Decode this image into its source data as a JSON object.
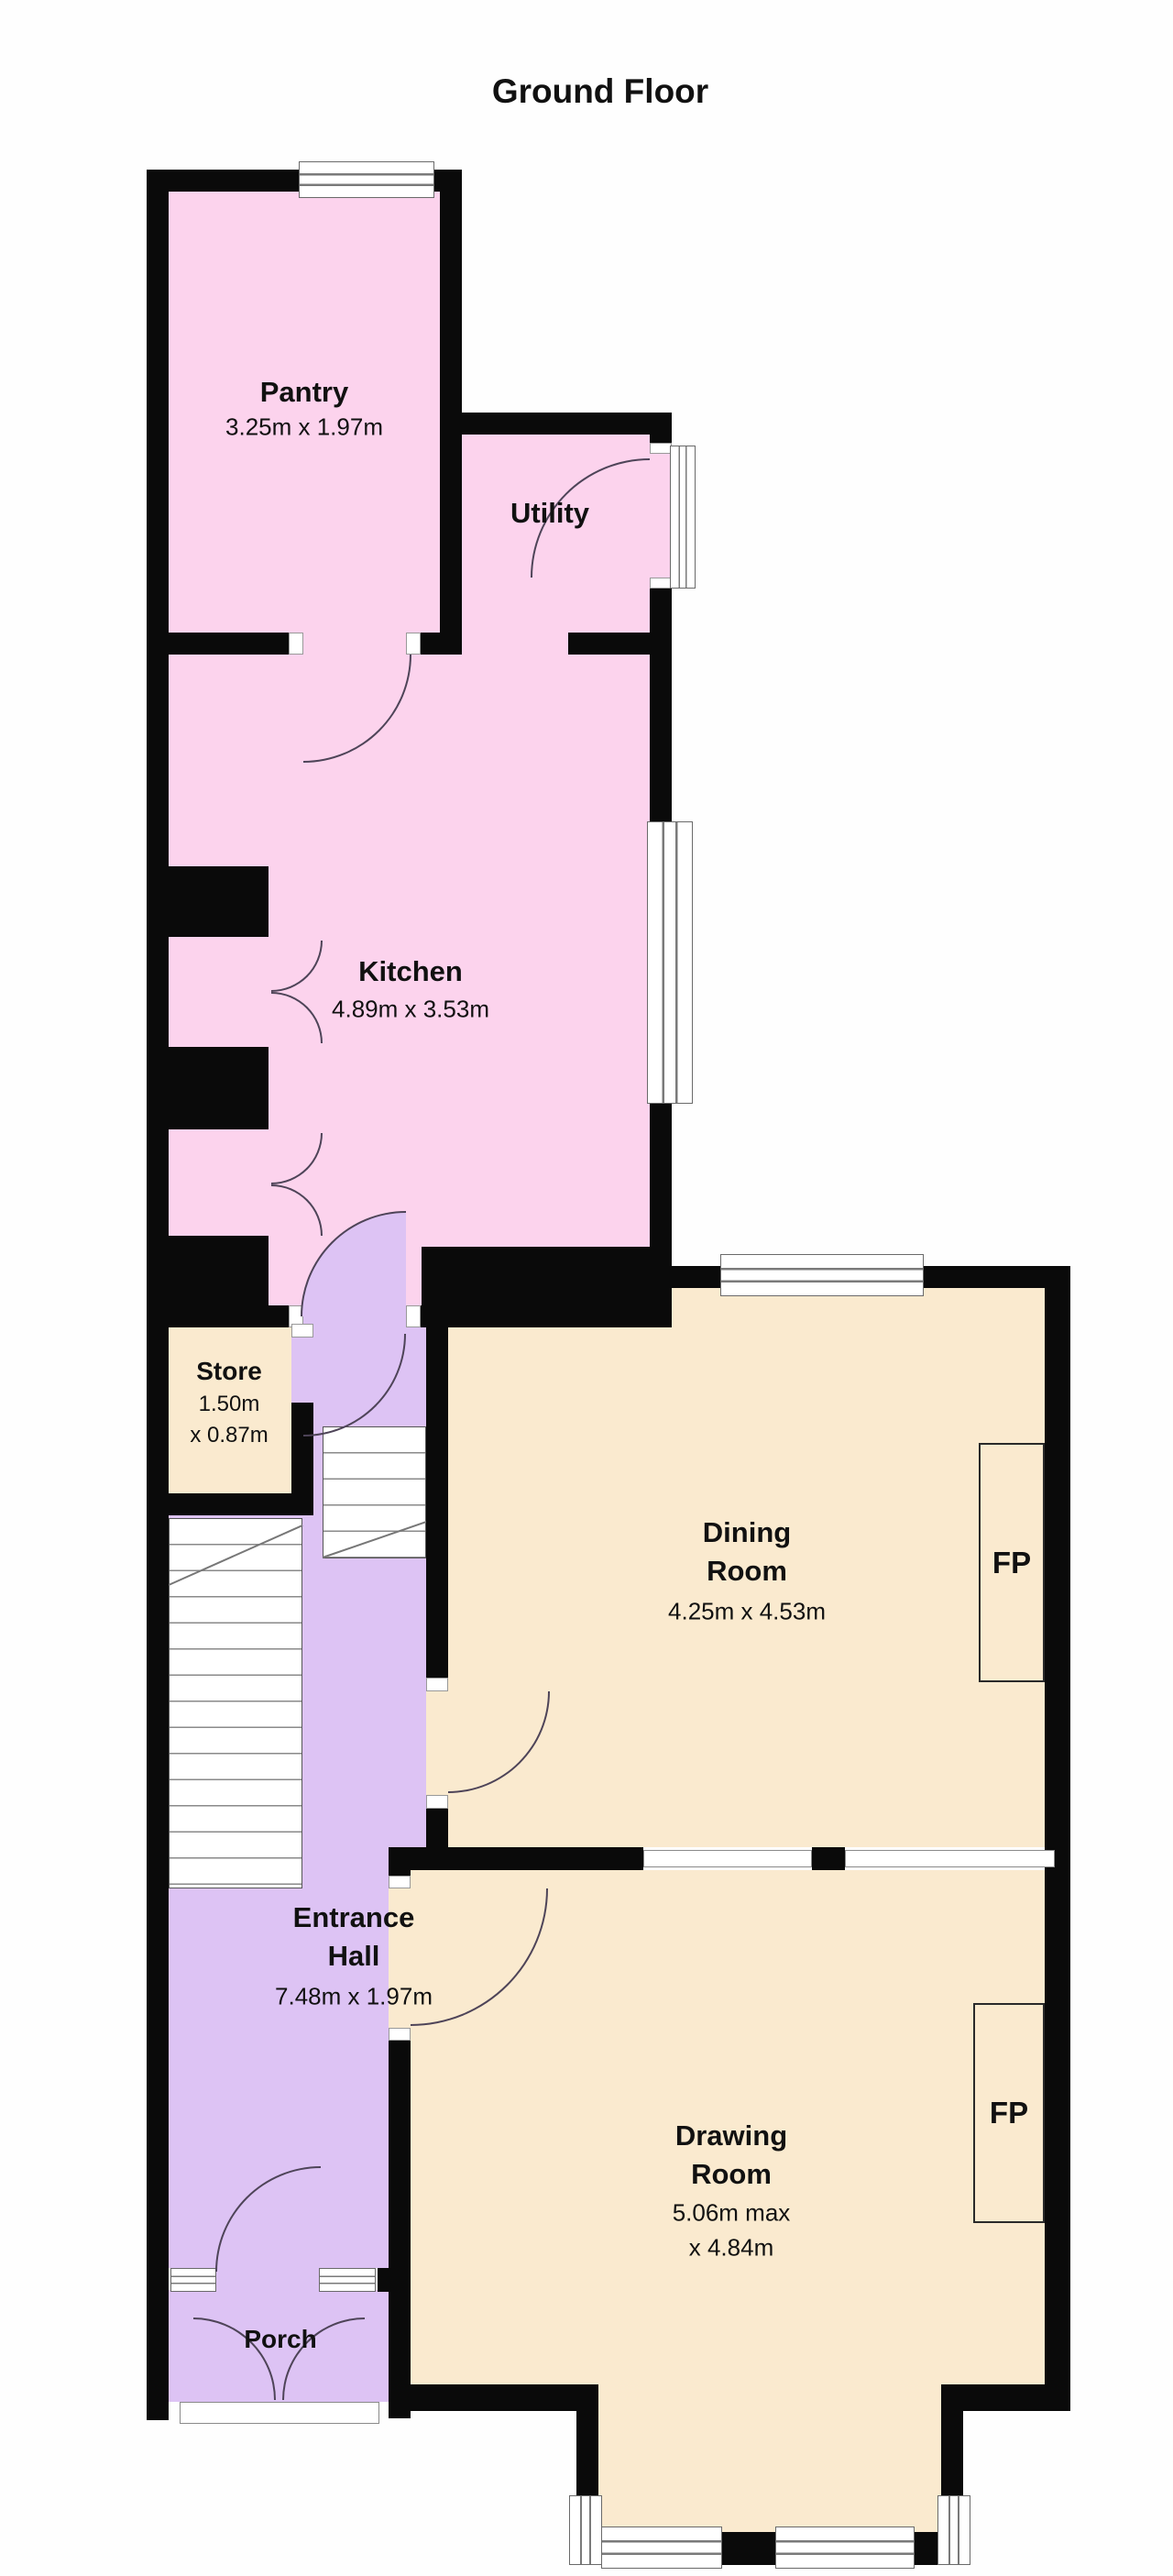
{
  "title": "Ground Floor",
  "colors": {
    "pink": "#fcd3ed",
    "lavender": "#ddc3f4",
    "beige": "#faeacf",
    "wall": "#0a0a0a"
  },
  "rooms": {
    "pantry": {
      "name": "Pantry",
      "dims": "3.25m x 1.97m"
    },
    "utility": {
      "name": "Utility"
    },
    "kitchen": {
      "name": "Kitchen",
      "dims": "4.89m x 3.53m"
    },
    "store": {
      "name": "Store",
      "dims1": "1.50m",
      "dims2": "x 0.87m"
    },
    "dining": {
      "name1": "Dining",
      "name2": "Room",
      "dims": "4.25m x 4.53m"
    },
    "entrance_hall": {
      "name1": "Entrance",
      "name2": "Hall",
      "dims": "7.48m x 1.97m"
    },
    "drawing": {
      "name1": "Drawing",
      "name2": "Room",
      "dims1": "5.06m max",
      "dims2": "x 4.84m"
    },
    "porch": {
      "name": "Porch"
    }
  },
  "fireplace": {
    "label": "FP"
  }
}
